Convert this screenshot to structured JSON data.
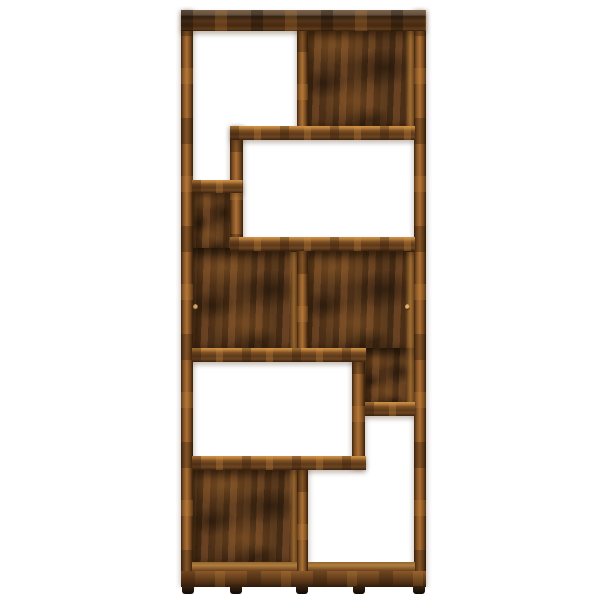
{
  "image": {
    "type": "product-photo",
    "subject": "geometric-bookshelf",
    "finish": "smoked-oak",
    "view": "front",
    "background": "white-studio"
  },
  "colors": {
    "bg": "#ffffff",
    "wood-bright": "#cf9347",
    "wood-mid": "#ad7134",
    "panel-base": "#4f3118"
  },
  "parts": [
    {
      "name": "back-panel-top-right",
      "kind": "panel",
      "x": 302,
      "y": 26,
      "w": 114,
      "h": 104
    },
    {
      "name": "back-panel-upper-left",
      "kind": "panel",
      "x": 191,
      "y": 186,
      "w": 45,
      "h": 68
    },
    {
      "name": "back-panel-mid-left",
      "kind": "panel",
      "x": 191,
      "y": 248,
      "w": 112,
      "h": 104
    },
    {
      "name": "back-panel-mid-right",
      "kind": "panel",
      "x": 302,
      "y": 248,
      "w": 114,
      "h": 104
    },
    {
      "name": "back-panel-mid-right-lower",
      "kind": "panel",
      "x": 360,
      "y": 348,
      "w": 56,
      "h": 60
    },
    {
      "name": "back-panel-bottom-left",
      "kind": "panel",
      "x": 191,
      "y": 466,
      "w": 112,
      "h": 100
    },
    {
      "name": "inner-wall-highlight-top-right",
      "kind": "wall-light",
      "x": 405,
      "y": 30,
      "w": 10,
      "h": 98
    },
    {
      "name": "inner-wall-highlight-mid-right",
      "kind": "wall-light",
      "x": 405,
      "y": 252,
      "w": 10,
      "h": 152
    },
    {
      "name": "inner-wall-highlight-mid-left",
      "kind": "wall-light",
      "x": 289,
      "y": 252,
      "w": 9,
      "h": 98
    },
    {
      "name": "inner-wall-highlight-bottom-left",
      "kind": "wall-light",
      "x": 289,
      "y": 470,
      "w": 9,
      "h": 94
    },
    {
      "name": "cam-lock-dot-left",
      "kind": "dot",
      "x": 193,
      "y": 304,
      "w": 5,
      "h": 6
    },
    {
      "name": "cam-lock-dot-right",
      "kind": "dot",
      "x": 405,
      "y": 304,
      "w": 5,
      "h": 6
    },
    {
      "name": "side-post-left",
      "kind": "post",
      "x": 181,
      "y": 10,
      "w": 12,
      "h": 577
    },
    {
      "name": "side-post-right",
      "kind": "post",
      "x": 414,
      "y": 10,
      "w": 12,
      "h": 577
    },
    {
      "name": "divider-top",
      "kind": "post",
      "x": 297,
      "y": 26,
      "w": 11,
      "h": 103
    },
    {
      "name": "divider-mid",
      "kind": "post",
      "x": 297,
      "y": 248,
      "w": 11,
      "h": 104
    },
    {
      "name": "divider-bottom",
      "kind": "post",
      "x": 297,
      "y": 466,
      "w": 11,
      "h": 106
    },
    {
      "name": "inner-post-upper",
      "kind": "post",
      "x": 230,
      "y": 126,
      "w": 13,
      "h": 125
    },
    {
      "name": "inner-post-lower",
      "kind": "post",
      "x": 352,
      "y": 348,
      "w": 13,
      "h": 122
    },
    {
      "name": "top-board",
      "kind": "top",
      "x": 181,
      "y": 10,
      "w": 245,
      "h": 21
    },
    {
      "name": "shelf-under-top-right",
      "kind": "shelf",
      "x": 230,
      "y": 126,
      "w": 185,
      "h": 14
    },
    {
      "name": "shelf-top-left-bottom",
      "kind": "shelf",
      "x": 192,
      "y": 180,
      "w": 51,
      "h": 13
    },
    {
      "name": "shelf-mid-upper",
      "kind": "shelf",
      "x": 230,
      "y": 237,
      "w": 185,
      "h": 14
    },
    {
      "name": "shelf-mid-left",
      "kind": "shelf",
      "x": 192,
      "y": 348,
      "w": 174,
      "h": 14
    },
    {
      "name": "shelf-right-nook-bottom",
      "kind": "shelf",
      "x": 365,
      "y": 402,
      "w": 50,
      "h": 14
    },
    {
      "name": "shelf-lower",
      "kind": "shelf",
      "x": 192,
      "y": 456,
      "w": 174,
      "h": 14
    },
    {
      "name": "floor-strip-left",
      "kind": "floor",
      "x": 192,
      "y": 562,
      "w": 105,
      "h": 10
    },
    {
      "name": "floor-strip-right",
      "kind": "floor",
      "x": 308,
      "y": 562,
      "w": 107,
      "h": 10
    },
    {
      "name": "bottom-plinth",
      "kind": "plinth",
      "x": 181,
      "y": 571,
      "w": 245,
      "h": 16
    },
    {
      "name": "foot-far-left",
      "kind": "foot",
      "x": 182,
      "y": 586,
      "w": 12,
      "h": 8
    },
    {
      "name": "foot-left",
      "kind": "foot",
      "x": 230,
      "y": 586,
      "w": 12,
      "h": 8
    },
    {
      "name": "foot-center",
      "kind": "foot",
      "x": 296,
      "y": 586,
      "w": 12,
      "h": 8
    },
    {
      "name": "foot-right",
      "kind": "foot",
      "x": 353,
      "y": 586,
      "w": 12,
      "h": 8
    },
    {
      "name": "foot-far-right",
      "kind": "foot",
      "x": 413,
      "y": 586,
      "w": 12,
      "h": 8
    }
  ]
}
